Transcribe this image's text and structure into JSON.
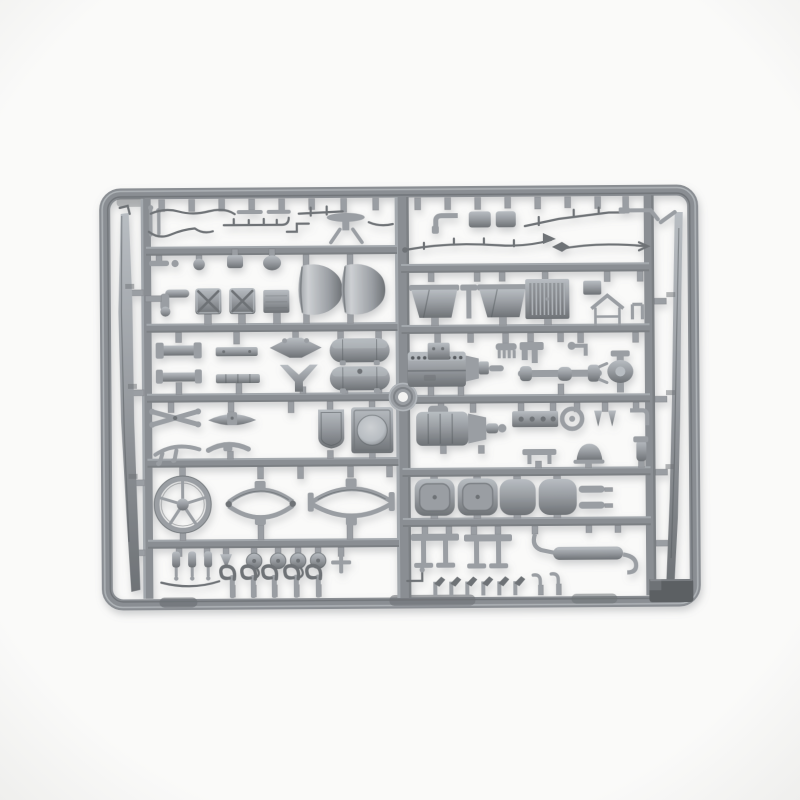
{
  "scene": {
    "description": "Product photograph of a gray injection-molded plastic model-kit sprue (runner frame) filled with truck model parts, on a plain white studio background",
    "text_visible": "",
    "parts": [
      "sprue-frame",
      "left-chassis-rail-part",
      "right-chassis-rail-part",
      "brake-line-wire-parts",
      "toolbox-parts",
      "engine-cowl-cone-parts",
      "fuel-tank-parts",
      "leaf-spring-parts",
      "steering-wheel-part",
      "spring-oval-assembly-parts",
      "shield-panel-part",
      "headlight-panel-part",
      "shock-absorber-parts",
      "pulley-parts",
      "tow-hook-parts",
      "air-scoop-parts",
      "radiator-part",
      "engine-block-part",
      "gearbox-part",
      "driveshaft-part",
      "differential-part",
      "seat-cushion-parts",
      "bench-bracket-parts",
      "exhaust-muffler-part",
      "dark-plate-part",
      "center-locating-boss"
    ]
  },
  "colors": {
    "background": "#fafaf9",
    "background_edge": "#eeeeec",
    "plastic_base": "#8a8e93",
    "plastic_mid": "#9a9ea3",
    "plastic_light": "#b8bdc2",
    "plastic_highlight": "#cdd0d3",
    "plastic_dark": "#6e7276",
    "plastic_deep": "#585c60",
    "dark_plate": "#5c6064",
    "hole_white": "#f3f3f2",
    "shadow": "#c9cbcc"
  }
}
